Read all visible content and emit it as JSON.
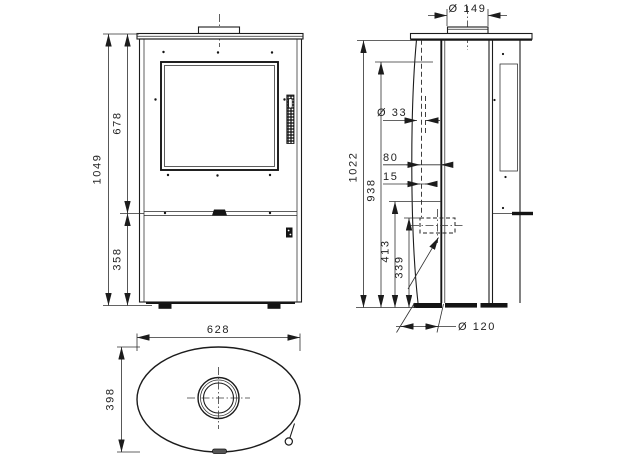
{
  "drawing": {
    "front_view": {
      "total_height": "1049",
      "upper_height": "678",
      "lower_height": "358"
    },
    "side_view": {
      "flue_collar_diameter": "Ø 149",
      "hidden_hole_diameter": "Ø 33",
      "offset_80": "80",
      "offset_15": "15",
      "total_height": "1022",
      "flue_center_height": "938",
      "outlet_center_height": "413",
      "outlet_bottom_height": "339",
      "air_inlet_diameter": "Ø 120"
    },
    "top_view": {
      "width": "628",
      "depth": "398"
    }
  }
}
